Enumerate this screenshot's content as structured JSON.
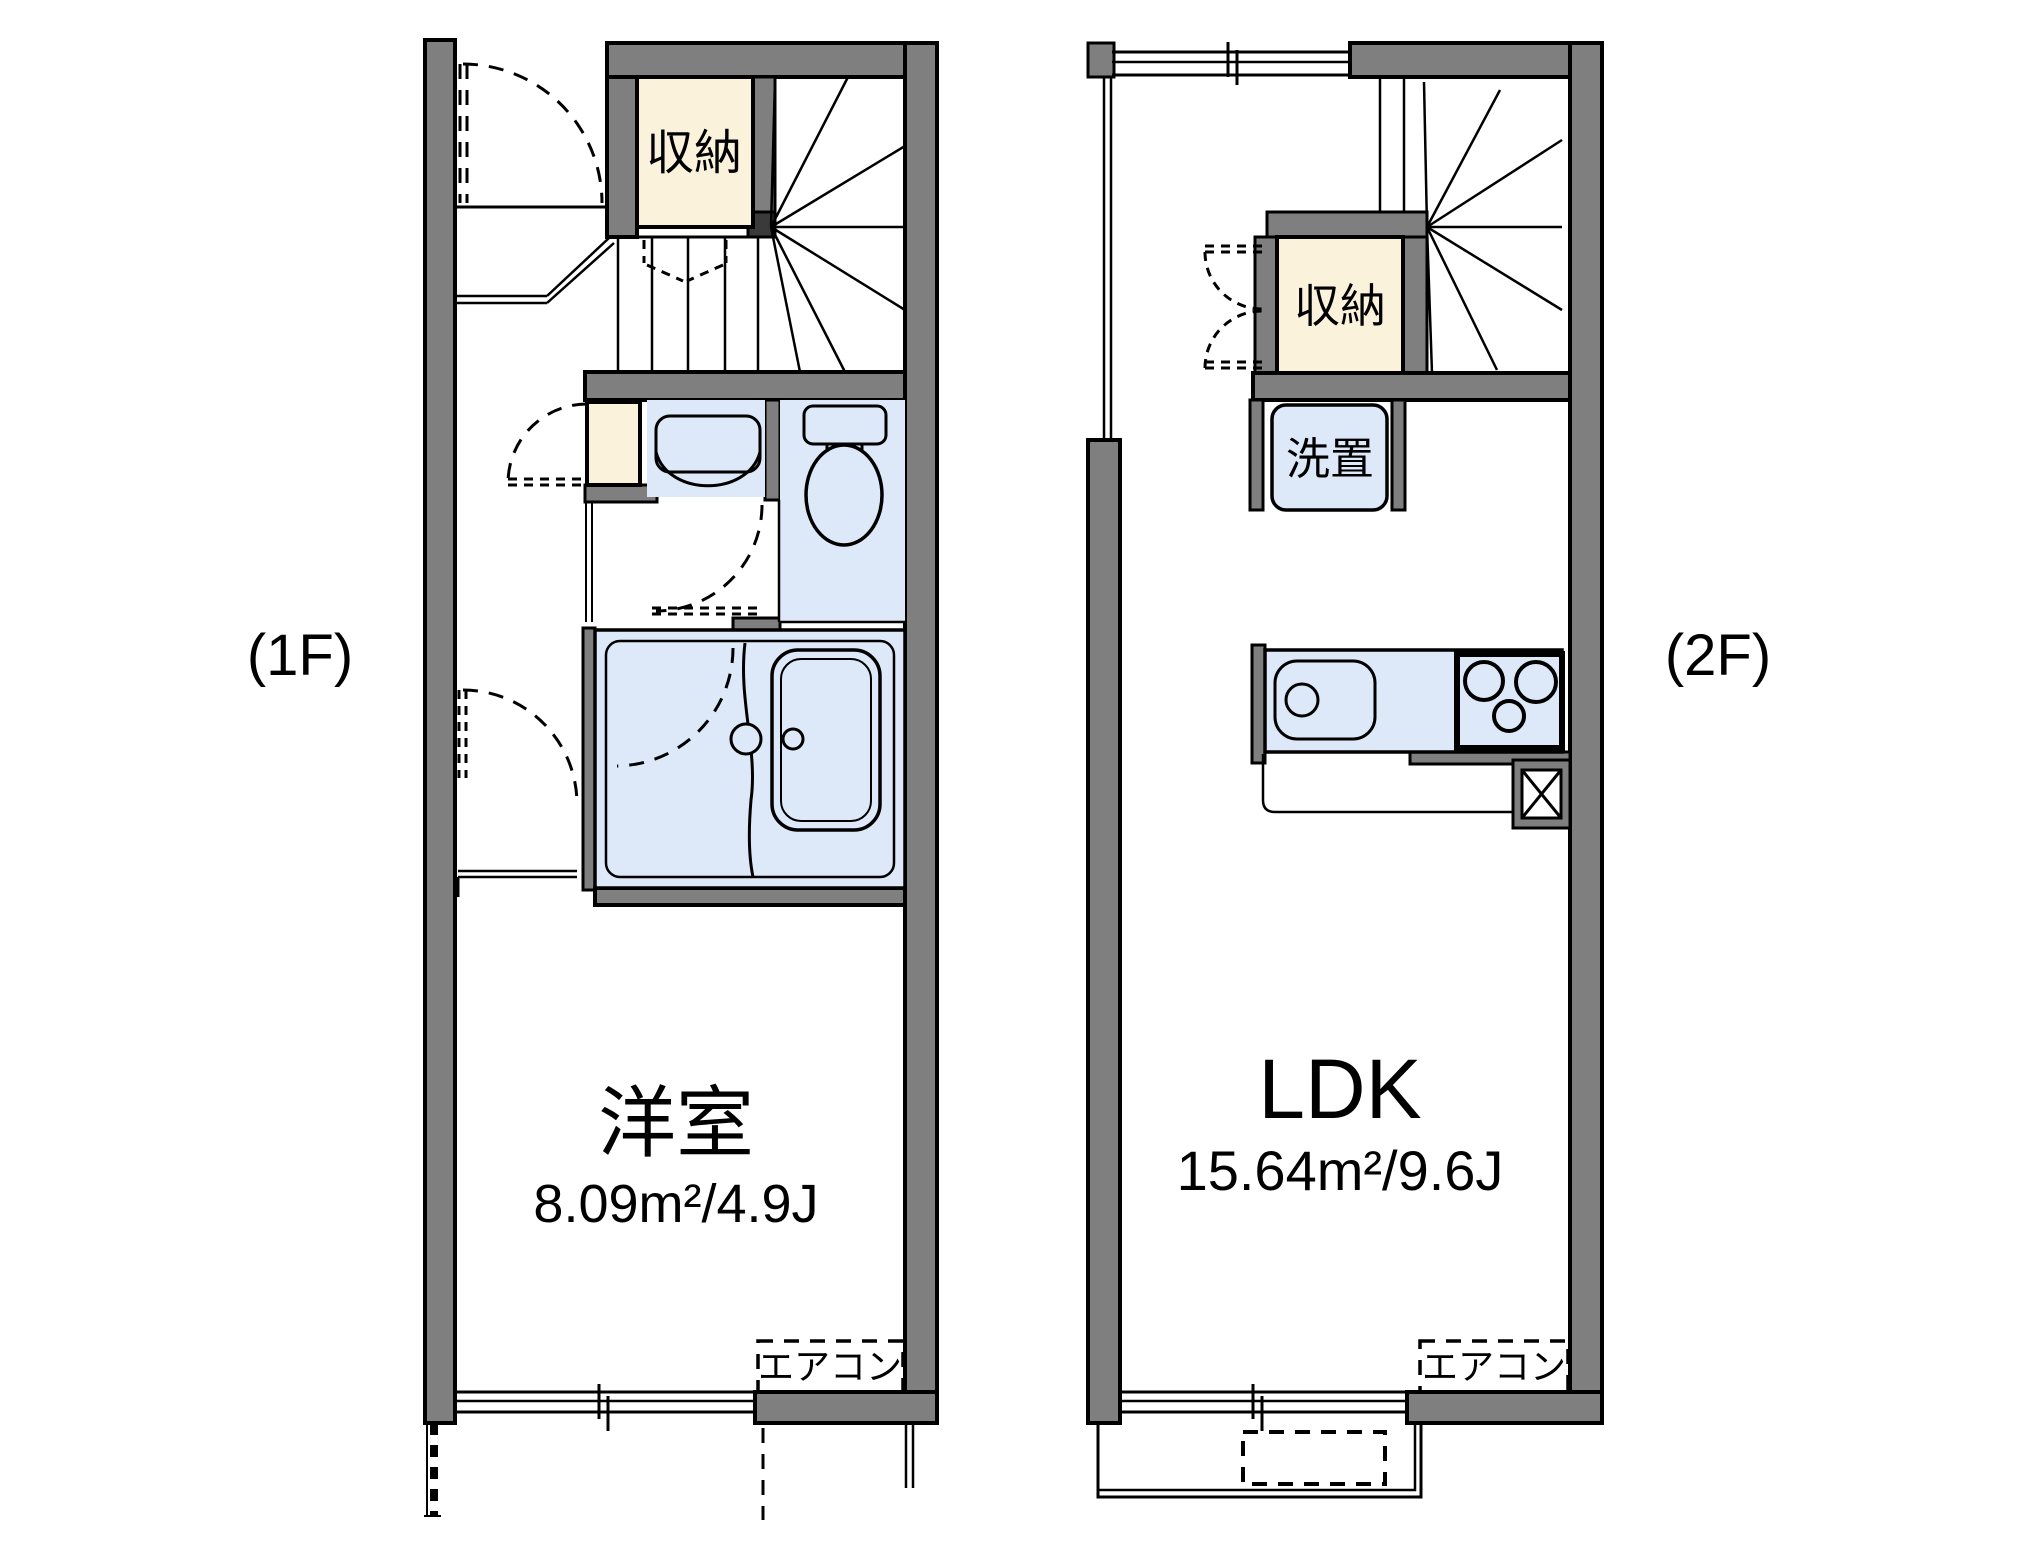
{
  "floor_1f": {
    "floor_label": "(1F)",
    "storage_label": "収納",
    "room_name": "洋室",
    "room_size": "8.09m²/4.9J",
    "aircon_label": "エアコン"
  },
  "floor_2f": {
    "floor_label": "(2F)",
    "storage_label": "収納",
    "washer_label": "洗置",
    "room_name": "LDK",
    "room_size": "15.64m²/9.6J",
    "aircon_label": "エアコン"
  },
  "colors": {
    "wall": "#7f7f7f",
    "storage_fill": "#fbf2dc",
    "water_fill": "#dde9f8",
    "line": "#000000",
    "background": "#ffffff"
  }
}
